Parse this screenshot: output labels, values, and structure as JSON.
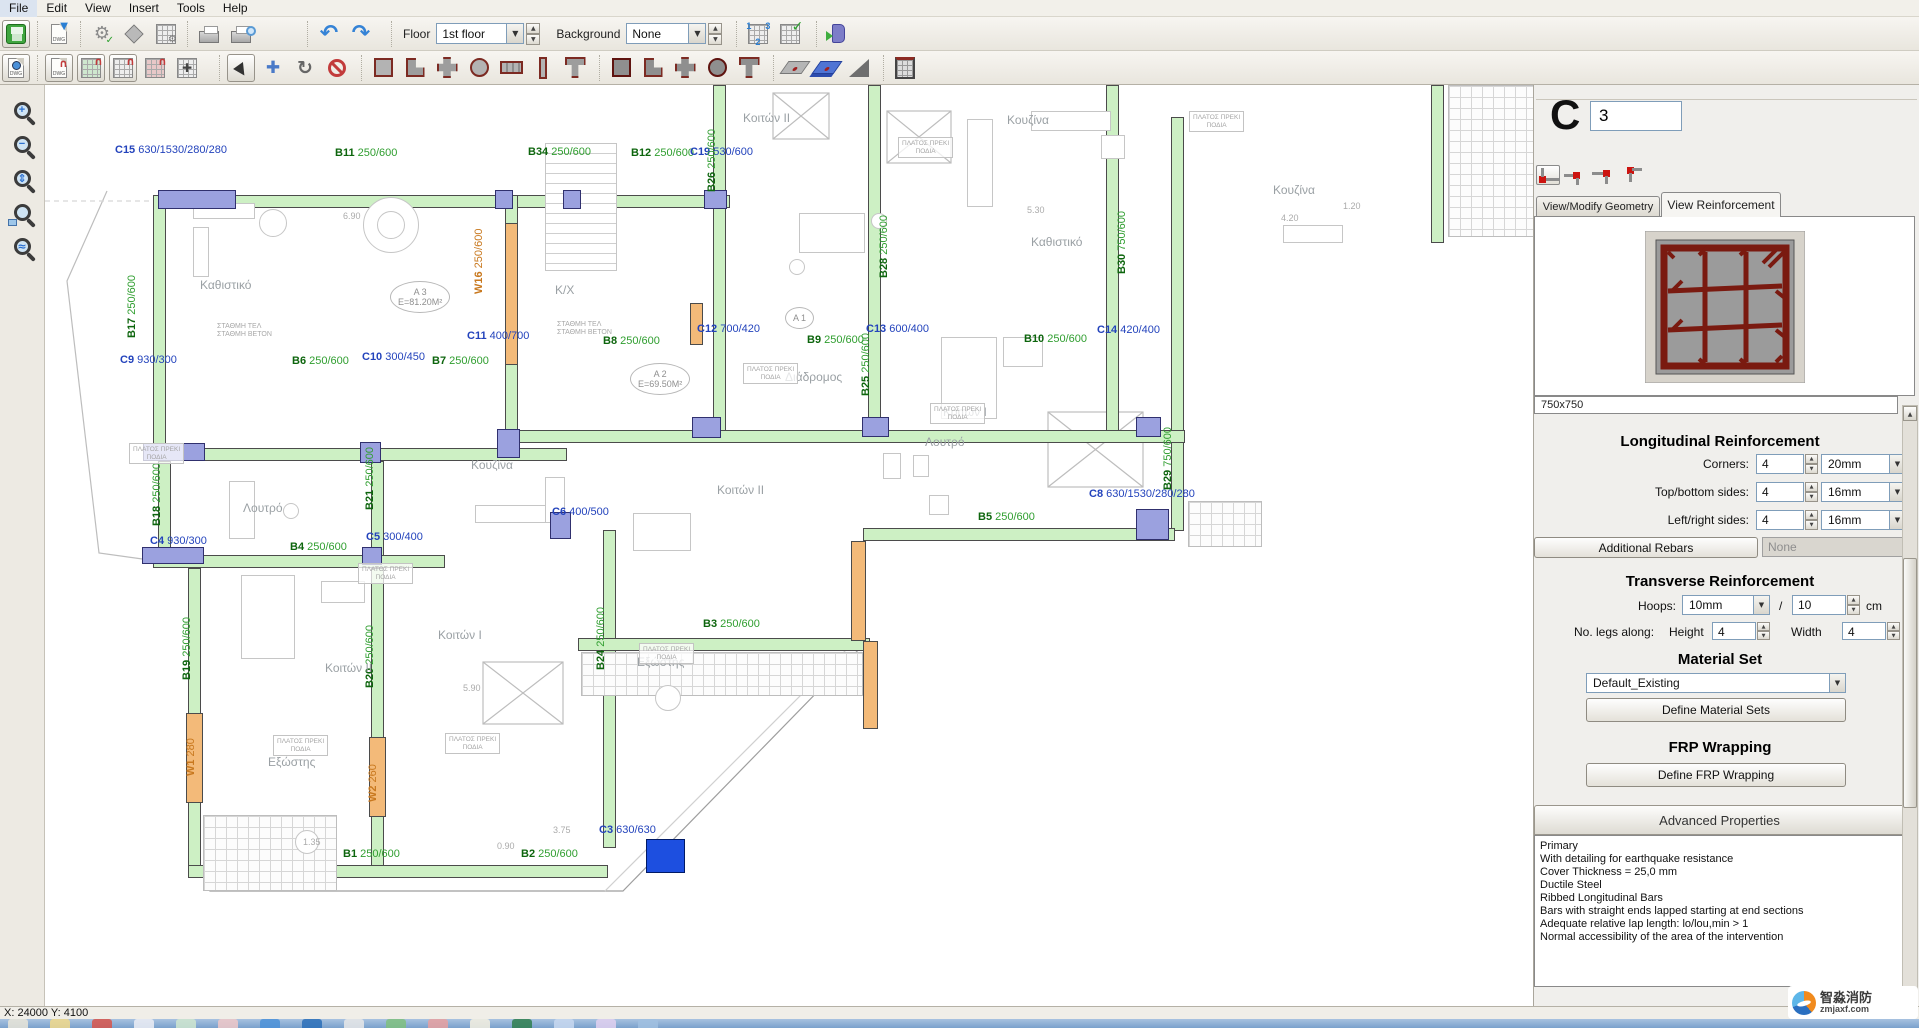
{
  "menu": {
    "items": [
      "File",
      "Edit",
      "View",
      "Insert",
      "Tools",
      "Help"
    ]
  },
  "toolbar": {
    "floor_label": "Floor",
    "floor_value": "1st floor",
    "background_label": "Background",
    "background_value": "None"
  },
  "icons": {
    "undo": "↶",
    "redo": "↷",
    "gear": "⚙",
    "check": "✓",
    "rotate": "↻",
    "move": "✚",
    "magnet": "∩",
    "dropdown_arrow": "▼",
    "up": "▲",
    "down": "▼"
  },
  "statusbar": {
    "coords": "X: 24000  Y: 4100"
  },
  "watermark": {
    "line1": "智淼消防",
    "line2": "zmjaxf.com"
  },
  "panel": {
    "type_letter": "C",
    "number": "3",
    "tabs": [
      {
        "label": "View/Modify Geometry"
      },
      {
        "label": "View Reinforcement"
      }
    ],
    "section_size": "750x750",
    "longitudinal": {
      "title": "Longitudinal Reinforcement",
      "rows": [
        {
          "label": "Corners:",
          "count": "4",
          "dia": "20mm"
        },
        {
          "label": "Top/bottom sides:",
          "count": "4",
          "dia": "16mm"
        },
        {
          "label": "Left/right sides:",
          "count": "4",
          "dia": "16mm"
        }
      ],
      "additional_button": "Additional Rebars",
      "additional_value": "None"
    },
    "transverse": {
      "title": "Transverse Reinforcement",
      "hoops_label": "Hoops:",
      "hoops_dia": "10mm",
      "slash": "/",
      "spacing": "10",
      "spacing_unit": "cm",
      "legs_label": "No. legs along:",
      "height_label": "Height",
      "height_value": "4",
      "width_label": "Width",
      "width_value": "4"
    },
    "material": {
      "title": "Material Set",
      "value": "Default_Existing",
      "button": "Define Material Sets"
    },
    "frp": {
      "title": "FRP Wrapping",
      "button": "Define FRP Wrapping"
    },
    "advanced": {
      "title": "Advanced Properties",
      "lines": [
        "Primary",
        "With detailing for earthquake resistance",
        "Cover Thickness = 25,0 mm",
        "Ductile Steel",
        "Ribbed Longitudinal Bars",
        "Bars with straight ends lapped starting at end sections",
        "Adequate relative lap length: lo/lou,min > 1",
        "Normal accessibility of the area of the intervention"
      ]
    }
  },
  "plan": {
    "beams": [
      [
        113,
        110,
        572,
        13
      ],
      [
        108,
        110,
        13,
        256
      ],
      [
        460,
        110,
        13,
        238
      ],
      [
        668,
        0,
        13,
        346
      ],
      [
        823,
        0,
        13,
        342
      ],
      [
        1061,
        0,
        13,
        346
      ],
      [
        1126,
        32,
        13,
        414
      ],
      [
        108,
        363,
        414,
        13
      ],
      [
        460,
        345,
        680,
        13
      ],
      [
        113,
        376,
        13,
        100
      ],
      [
        326,
        376,
        13,
        100
      ],
      [
        108,
        470,
        292,
        13
      ],
      [
        143,
        483,
        13,
        300
      ],
      [
        326,
        483,
        13,
        300
      ],
      [
        558,
        445,
        13,
        318
      ],
      [
        143,
        780,
        420,
        13
      ],
      [
        533,
        553,
        292,
        13
      ],
      [
        818,
        443,
        312,
        13
      ],
      [
        1386,
        0,
        13,
        158
      ]
    ],
    "walls": [
      [
        460,
        138,
        13,
        142
      ],
      [
        505,
        110,
        56,
        13
      ],
      [
        141,
        628,
        17,
        90
      ],
      [
        324,
        652,
        17,
        80
      ],
      [
        806,
        456,
        15,
        100
      ],
      [
        818,
        556,
        15,
        88
      ],
      [
        645,
        218,
        13,
        42
      ]
    ],
    "columns": [
      [
        113,
        105,
        78,
        19
      ],
      [
        450,
        105,
        18,
        19
      ],
      [
        518,
        105,
        18,
        19
      ],
      [
        659,
        105,
        23,
        19
      ],
      [
        98,
        358,
        62,
        18
      ],
      [
        315,
        357,
        21,
        21
      ],
      [
        452,
        344,
        23,
        29
      ],
      [
        647,
        332,
        29,
        21
      ],
      [
        817,
        332,
        27,
        20
      ],
      [
        1091,
        332,
        25,
        20
      ],
      [
        97,
        462,
        62,
        17
      ],
      [
        317,
        462,
        20,
        18
      ],
      [
        505,
        427,
        21,
        27
      ],
      [
        1091,
        424,
        33,
        31
      ]
    ],
    "selected_column": [
      601,
      754,
      39,
      34
    ],
    "grids": [
      [
        1403,
        0,
        88,
        152
      ],
      [
        1143,
        416,
        74,
        46
      ],
      [
        158,
        730,
        134,
        76
      ],
      [
        536,
        567,
        282,
        44
      ]
    ],
    "furniture": [
      [
        148,
        118,
        62,
        16
      ],
      [
        148,
        142,
        16,
        50
      ],
      [
        214,
        124,
        28,
        28,
        "c"
      ],
      [
        318,
        112,
        56,
        56,
        "c"
      ],
      [
        332,
        126,
        28,
        28,
        "c"
      ],
      [
        500,
        58,
        72,
        128,
        "s"
      ],
      [
        754,
        128,
        66,
        40
      ],
      [
        744,
        174,
        16,
        16,
        "c"
      ],
      [
        826,
        128,
        16,
        16,
        "c"
      ],
      [
        922,
        34,
        26,
        88
      ],
      [
        986,
        26,
        80,
        20
      ],
      [
        1056,
        50,
        24,
        24
      ],
      [
        1238,
        140,
        60,
        18
      ],
      [
        196,
        490,
        54,
        84
      ],
      [
        276,
        496,
        44,
        22
      ],
      [
        896,
        252,
        56,
        82
      ],
      [
        958,
        252,
        40,
        30
      ],
      [
        184,
        396,
        26,
        58
      ],
      [
        238,
        418,
        16,
        16,
        "c"
      ],
      [
        430,
        420,
        72,
        18
      ],
      [
        500,
        392,
        20,
        46
      ],
      [
        838,
        368,
        18,
        26
      ],
      [
        868,
        370,
        16,
        22
      ],
      [
        588,
        428,
        58,
        38
      ],
      [
        884,
        410,
        20,
        20
      ],
      [
        250,
        745,
        24,
        24,
        "c"
      ],
      [
        610,
        600,
        26,
        26,
        "c"
      ]
    ],
    "labels": [
      {
        "k": "c",
        "t": "C15",
        "d": "630/1530/280/280",
        "x": 70,
        "y": 60
      },
      {
        "k": "b",
        "t": "B11",
        "d": "250/600",
        "x": 290,
        "y": 63
      },
      {
        "k": "b",
        "t": "B34",
        "d": "250/600",
        "x": 483,
        "y": 62
      },
      {
        "k": "b",
        "t": "B12",
        "d": "250/600",
        "x": 586,
        "y": 63
      },
      {
        "k": "c",
        "t": "C19",
        "d": "530/600",
        "x": 645,
        "y": 62
      },
      {
        "k": "b",
        "t": "B26",
        "d": "250/600",
        "x": 673,
        "y": 96,
        "v": 1
      },
      {
        "k": "b",
        "t": "B28",
        "d": "250/600",
        "x": 845,
        "y": 182,
        "v": 1
      },
      {
        "k": "b",
        "t": "B30",
        "d": "750/600",
        "x": 1083,
        "y": 178,
        "v": 1
      },
      {
        "k": "b",
        "t": "B17",
        "d": "250/600",
        "x": 93,
        "y": 242,
        "v": 1
      },
      {
        "k": "b",
        "t": "B25",
        "d": "250/600",
        "x": 827,
        "y": 300,
        "v": 1
      },
      {
        "k": "c",
        "t": "C9",
        "d": "930/300",
        "x": 75,
        "y": 270
      },
      {
        "k": "b",
        "t": "B6",
        "d": "250/600",
        "x": 247,
        "y": 271
      },
      {
        "k": "c",
        "t": "C10",
        "d": "300/450",
        "x": 317,
        "y": 267
      },
      {
        "k": "b",
        "t": "B7",
        "d": "250/600",
        "x": 387,
        "y": 271
      },
      {
        "k": "c",
        "t": "C11",
        "d": "400/700",
        "x": 422,
        "y": 246
      },
      {
        "k": "b",
        "t": "B8",
        "d": "250/600",
        "x": 558,
        "y": 251
      },
      {
        "k": "c",
        "t": "C12",
        "d": "700/420",
        "x": 652,
        "y": 239
      },
      {
        "k": "b",
        "t": "B9",
        "d": "250/600",
        "x": 762,
        "y": 250
      },
      {
        "k": "c",
        "t": "C13",
        "d": "600/400",
        "x": 821,
        "y": 239
      },
      {
        "k": "b",
        "t": "B10",
        "d": "250/600",
        "x": 979,
        "y": 249
      },
      {
        "k": "c",
        "t": "C14",
        "d": "420/400",
        "x": 1052,
        "y": 240
      },
      {
        "k": "b",
        "t": "B18",
        "d": "250/600",
        "x": 118,
        "y": 430,
        "v": 1
      },
      {
        "k": "b",
        "t": "B21",
        "d": "250/600",
        "x": 331,
        "y": 414,
        "v": 1
      },
      {
        "k": "b",
        "t": "B29",
        "d": "750/600",
        "x": 1129,
        "y": 394,
        "v": 1
      },
      {
        "k": "c",
        "t": "C8",
        "d": "630/1530/280/280",
        "x": 1044,
        "y": 404
      },
      {
        "k": "b",
        "t": "B5",
        "d": "250/600",
        "x": 933,
        "y": 427
      },
      {
        "k": "c",
        "t": "C4",
        "d": "930/300",
        "x": 105,
        "y": 451
      },
      {
        "k": "b",
        "t": "B4",
        "d": "250/600",
        "x": 245,
        "y": 457
      },
      {
        "k": "c",
        "t": "C5",
        "d": "300/400",
        "x": 321,
        "y": 447
      },
      {
        "k": "c",
        "t": "C6",
        "d": "400/500",
        "x": 507,
        "y": 422
      },
      {
        "k": "b",
        "t": "B19",
        "d": "250/600",
        "x": 148,
        "y": 584,
        "v": 1
      },
      {
        "k": "b",
        "t": "B20",
        "d": "250/600",
        "x": 331,
        "y": 592,
        "v": 1
      },
      {
        "k": "b",
        "t": "B24",
        "d": "250/600",
        "x": 562,
        "y": 574,
        "v": 1
      },
      {
        "k": "b",
        "t": "B3",
        "d": "250/600",
        "x": 658,
        "y": 534
      },
      {
        "k": "w",
        "t": "W1",
        "d": "280",
        "x": 152,
        "y": 680,
        "v": 1
      },
      {
        "k": "w",
        "t": "W2",
        "d": "260",
        "x": 334,
        "y": 706,
        "v": 1
      },
      {
        "k": "w",
        "t": "W16",
        "d": "250/600",
        "x": 440,
        "y": 198,
        "v": 1
      },
      {
        "k": "c",
        "t": "C3",
        "d": "630/630",
        "x": 554,
        "y": 740
      },
      {
        "k": "b",
        "t": "B1",
        "d": "250/600",
        "x": 298,
        "y": 764
      },
      {
        "k": "b",
        "t": "B2",
        "d": "250/600",
        "x": 476,
        "y": 764
      }
    ],
    "rooms": [
      {
        "t": "Καθιστικό",
        "x": 155,
        "y": 193
      },
      {
        "t": "Κ/Χ",
        "x": 510,
        "y": 198
      },
      {
        "t": "Κοιτών ΙΙ",
        "x": 698,
        "y": 26
      },
      {
        "t": "Κουζίνα",
        "x": 962,
        "y": 28
      },
      {
        "t": "Καθιστικό",
        "x": 986,
        "y": 150
      },
      {
        "t": "Διάδρομος",
        "x": 740,
        "y": 285
      },
      {
        "t": "Κουζίνα",
        "x": 426,
        "y": 373
      },
      {
        "t": "Λουτρό",
        "x": 198,
        "y": 416
      },
      {
        "t": "Κοιτών Ι",
        "x": 898,
        "y": 320
      },
      {
        "t": "Κοιτών ΙΙ",
        "x": 672,
        "y": 398
      },
      {
        "t": "Λουτρό",
        "x": 880,
        "y": 350
      },
      {
        "t": "Κοιτών Ι",
        "x": 393,
        "y": 543
      },
      {
        "t": "Κοιτών ΙΙ",
        "x": 280,
        "y": 576
      },
      {
        "t": "Εξώστης",
        "x": 223,
        "y": 670
      },
      {
        "t": "Εξώστης",
        "x": 592,
        "y": 570
      },
      {
        "t": "Κουζίνα",
        "x": 1228,
        "y": 98
      }
    ],
    "areas": [
      {
        "t": "Α 3",
        "d": "Ε=81.20Μ²",
        "x": 345,
        "y": 196
      },
      {
        "t": "Α 2",
        "d": "Ε=69.50Μ²",
        "x": 585,
        "y": 278
      },
      {
        "t": "Α 1",
        "d": "",
        "x": 740,
        "y": 222
      }
    ],
    "notes": [
      {
        "l1": "ΠΛΑΤΟΣ ΠΡΕΚΙ",
        "l2": "ΠΟΔΙΑ",
        "x": 853,
        "y": 52
      },
      {
        "l1": "ΠΛΑΤΟΣ ΠΡΕΚΙ",
        "l2": "ΠΟΔΙΑ",
        "x": 698,
        "y": 278
      },
      {
        "l1": "ΠΛΑΤΟΣ ΠΡΕΚΙ",
        "l2": "ΠΟΔΙΑ",
        "x": 885,
        "y": 318
      },
      {
        "l1": "ΠΛΑΤΟΣ ΠΡΕΚΙ",
        "l2": "ΠΟΔΙΑ",
        "x": 84,
        "y": 358
      },
      {
        "l1": "ΠΛΑΤΟΣ ΠΡΕΚΙ",
        "l2": "ΠΟΔΙΑ",
        "x": 594,
        "y": 558
      },
      {
        "l1": "ΠΛΑΤΟΣ ΠΡΕΚΙ",
        "l2": "ΠΟΔΙΑ",
        "x": 400,
        "y": 648
      },
      {
        "l1": "ΠΛΑΤΟΣ ΠΡΕΚΙ",
        "l2": "ΠΟΔΙΑ",
        "x": 228,
        "y": 650
      },
      {
        "l1": "ΠΛΑΤΟΣ ΠΡΕΚΙ",
        "l2": "ΠΟΔΙΑ",
        "x": 1144,
        "y": 26
      },
      {
        "l1": "ΠΛΑΤΟΣ ΠΡΕΚΙ",
        "l2": "ΠΟΔΙΑ",
        "x": 313,
        "y": 478
      }
    ],
    "stathmi": [
      {
        "l1": "ΣΤΑΘΜΗ ΤΕΛ",
        "l2": "ΣΤΑΘΜΗ ΒΕΤΟΝ",
        "x": 512,
        "y": 236
      },
      {
        "l1": "ΣΤΑΘΜΗ ΤΕΛ",
        "l2": "ΣΤΑΘΜΗ ΒΕΤΟΝ",
        "x": 172,
        "y": 238
      }
    ],
    "dims": [
      {
        "t": "6.90",
        "x": 298,
        "y": 126
      },
      {
        "t": "5.30",
        "x": 982,
        "y": 120
      },
      {
        "t": "4.20",
        "x": 1236,
        "y": 128
      },
      {
        "t": "1.20",
        "x": 1298,
        "y": 116
      },
      {
        "t": "3.75",
        "x": 508,
        "y": 740
      },
      {
        "t": "0.90",
        "x": 452,
        "y": 756
      },
      {
        "t": "5.90",
        "x": 418,
        "y": 598
      },
      {
        "t": "1.35",
        "x": 258,
        "y": 752
      }
    ]
  }
}
